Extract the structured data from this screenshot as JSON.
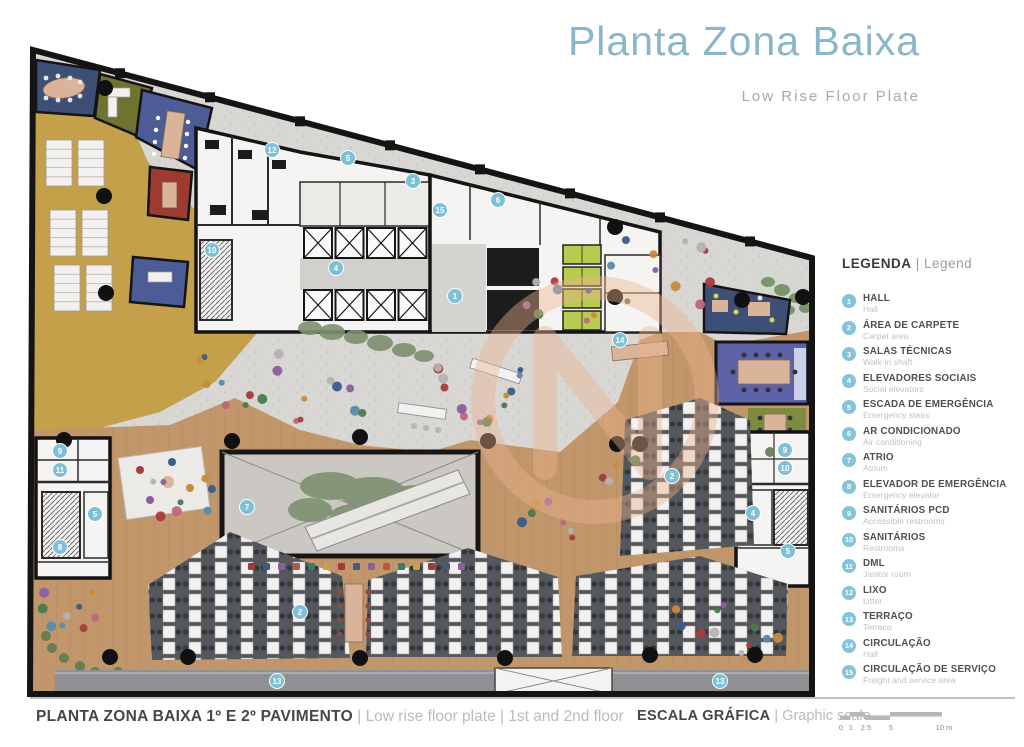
{
  "title": {
    "main": "Planta Zona Baixa",
    "sub": "Low Rise Floor Plate"
  },
  "legend": {
    "heading_pt": "LEGENDA",
    "heading_sep": " | ",
    "heading_en": "Legend",
    "items": [
      {
        "n": "1",
        "pt": "HALL",
        "en": "Hall"
      },
      {
        "n": "2",
        "pt": "ÁREA DE CARPETE",
        "en": "Carpet area"
      },
      {
        "n": "3",
        "pt": "SALAS TÉCNICAS",
        "en": "Walk-in shaft"
      },
      {
        "n": "4",
        "pt": "ELEVADORES SOCIAIS",
        "en": "Social elevators"
      },
      {
        "n": "5",
        "pt": "ESCADA DE EMERGÊNCIA",
        "en": "Emergency stairs"
      },
      {
        "n": "6",
        "pt": "AR CONDICIONADO",
        "en": "Air conditioning"
      },
      {
        "n": "7",
        "pt": "ATRIO",
        "en": "Atrium"
      },
      {
        "n": "8",
        "pt": "ELEVADOR DE EMERGÊNCIA",
        "en": "Emergency elevator"
      },
      {
        "n": "9",
        "pt": "SANITÁRIOS PCD",
        "en": "Accessible restrooms"
      },
      {
        "n": "10",
        "pt": "SANITÁRIOS",
        "en": "Restrooms"
      },
      {
        "n": "11",
        "pt": "DML",
        "en": "Janitor room"
      },
      {
        "n": "12",
        "pt": "LIXO",
        "en": "Litter"
      },
      {
        "n": "13",
        "pt": "TERRAÇO",
        "en": "Terraco"
      },
      {
        "n": "14",
        "pt": "CIRCULAÇÃO",
        "en": "Hall"
      },
      {
        "n": "15",
        "pt": "CIRCULAÇÃO DE SERVIÇO",
        "en": "Freight and service area"
      }
    ]
  },
  "footer": {
    "caption_pt": "PLANTA ZONA BAIXA 1º E 2º PAVIMENTO",
    "caption_sep": " | ",
    "caption_en1": "Low rise floor plate",
    "caption_en2": "1st and 2nd floor",
    "scale_pt": "ESCALA GRÁFICA",
    "scale_sep": " | ",
    "scale_en": "Graphic scale",
    "scale_labels": [
      "0",
      "1",
      "2.5",
      "5",
      "10 m"
    ]
  },
  "plan": {
    "watermark_letter": "N",
    "markers": [
      {
        "n": "1",
        "x": 455,
        "y": 296
      },
      {
        "n": "2",
        "x": 672,
        "y": 476
      },
      {
        "n": "2",
        "x": 300,
        "y": 612
      },
      {
        "n": "3",
        "x": 413,
        "y": 181
      },
      {
        "n": "4",
        "x": 336,
        "y": 268
      },
      {
        "n": "4",
        "x": 753,
        "y": 513
      },
      {
        "n": "5",
        "x": 348,
        "y": 158
      },
      {
        "n": "5",
        "x": 95,
        "y": 514
      },
      {
        "n": "5",
        "x": 788,
        "y": 551
      },
      {
        "n": "6",
        "x": 498,
        "y": 200
      },
      {
        "n": "7",
        "x": 247,
        "y": 507
      },
      {
        "n": "8",
        "x": 60,
        "y": 547
      },
      {
        "n": "9",
        "x": 60,
        "y": 451
      },
      {
        "n": "9",
        "x": 785,
        "y": 450
      },
      {
        "n": "10",
        "x": 212,
        "y": 250
      },
      {
        "n": "10",
        "x": 785,
        "y": 468
      },
      {
        "n": "11",
        "x": 60,
        "y": 470
      },
      {
        "n": "12",
        "x": 272,
        "y": 150
      },
      {
        "n": "13",
        "x": 277,
        "y": 681
      },
      {
        "n": "13",
        "x": 720,
        "y": 681
      },
      {
        "n": "14",
        "x": 620,
        "y": 340
      },
      {
        "n": "15",
        "x": 440,
        "y": 210
      }
    ]
  },
  "colors": {
    "title_blue": "#8ab6c9",
    "marker_blue": "#7ec1d6",
    "wood": "#c2966b",
    "terrazzo": "#d9d7d3",
    "carpet_dark": "#54585c",
    "mustard": "#c4a04a",
    "navy": "#3e4f76",
    "blue_room": "#4d5b96",
    "olive": "#6f7330",
    "red_room": "#9e3b31",
    "purple_room": "#5d62a8",
    "green_rug": "#7d8c40",
    "lime_booths": "#b6cb4f",
    "terrace_gray": "#8f9093"
  }
}
